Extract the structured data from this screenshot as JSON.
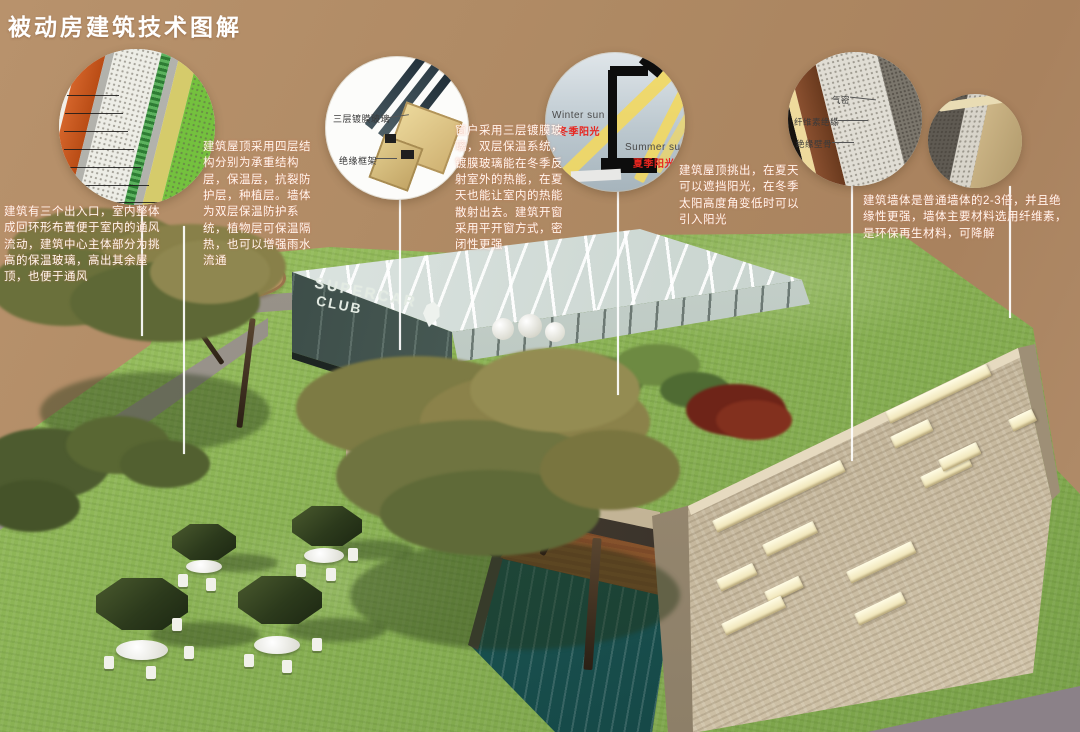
{
  "title": "被动房建筑技术图解",
  "notes": {
    "entrance": "建筑有三个出入口，室内整体成回环形布置便于室内的通风流动，建筑中心主体部分为挑高的保温玻璃，高出其余屋顶，也便于通风",
    "roof": "建筑屋顶采用四层结构分别为承重结构层，保温层，抗裂防护层，种植层。墙体为双层保温防护系统，植物层可保温隔热，也可以增强雨水流通",
    "window": "窗户采用三层镀膜玻璃，双层保温系统，镀膜玻璃能在冬季反射室外的热能，在夏天也能让室内的热能散射出去。建筑开窗采用平开窗方式，密闭性更强",
    "shading": "建筑屋顶挑出，在夏天可以遮挡阳光，在冬季太阳高度角变低时可以引入阳光",
    "wall": "建筑墙体是普通墙体的2-3倍，并且绝缘性更强，墙体主要材料选用纤维素，是环保再生材料，可降解"
  },
  "callout_labels": {
    "window_glass": "三层镀膜玻璃",
    "window_frame": "绝缘框架",
    "winter_sun_en": "Winter sun",
    "winter_sun_zh": "冬季阳光",
    "summer_sun_en": "Summer sun",
    "summer_sun_zh": "夏季阳光",
    "wall_airtight": "气密",
    "wall_cellulose": "纤维素绝缘",
    "wall_stud": "绝缘壁骨"
  },
  "building_sign": {
    "line1": "SUPERCAR",
    "line2": "CLUB"
  },
  "colors": {
    "background_tan": "#b08b65",
    "grass_green": "#8fb855",
    "stone_wall": "#c3b59b",
    "pool_teal": "#2a6b68",
    "sun_label_red": "#e8251f",
    "umbrella_green": "#33421f",
    "title_color": "#ffffff"
  }
}
